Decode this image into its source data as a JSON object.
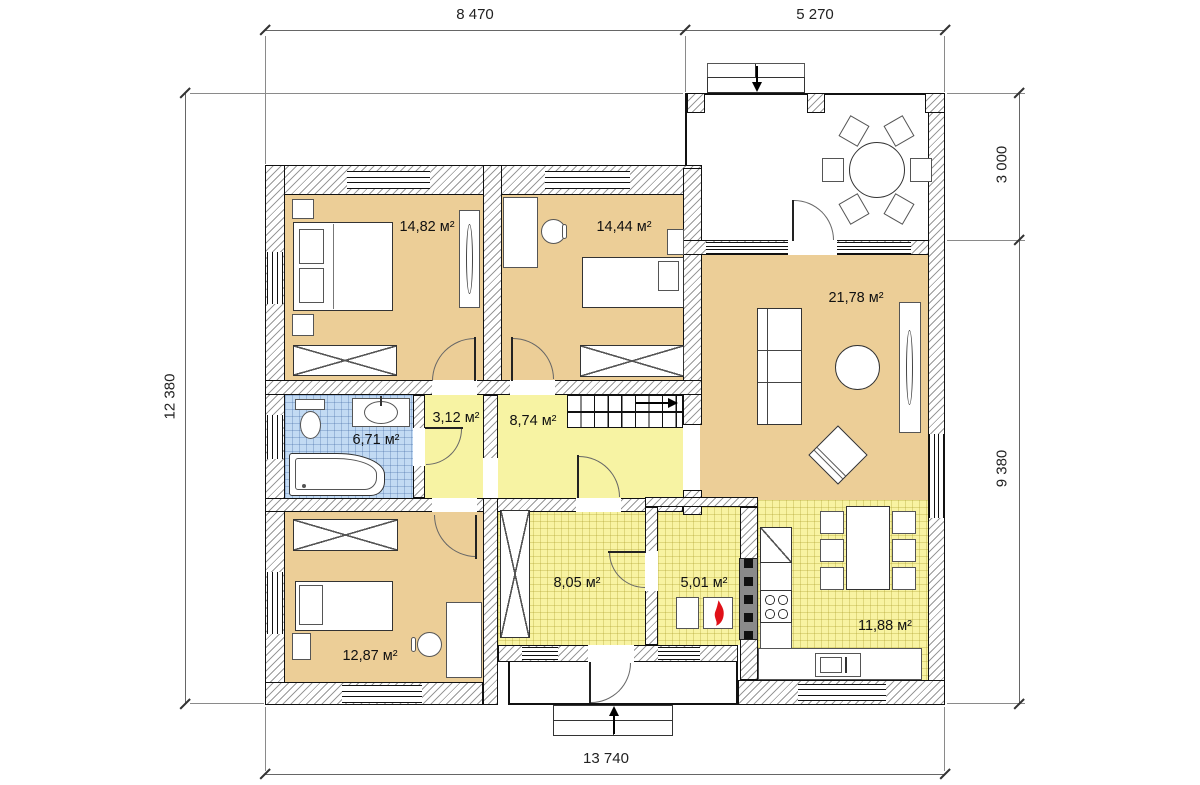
{
  "plan": {
    "dimensions": {
      "top_main": "8 470",
      "top_terrace": "5 270",
      "left_total": "12 380",
      "right_terrace": "3 000",
      "right_main": "9 380",
      "bottom_total": "13 740"
    },
    "rooms": {
      "bedroom1": {
        "area": "14,82 м²"
      },
      "bedroom2": {
        "area": "14,44 м²"
      },
      "living": {
        "area": "21,78 м²"
      },
      "bathroom": {
        "area": "6,71 м²"
      },
      "corridor": {
        "area": "3,12 м²"
      },
      "hall": {
        "area": "8,74 м²"
      },
      "entry": {
        "area": "8,05 м²"
      },
      "boiler": {
        "area": "5,01 м²"
      },
      "bedroom3": {
        "area": "12,87 м²"
      },
      "kitchen": {
        "area": "11,88 м²"
      }
    },
    "colors": {
      "room_tan": "#ecce97",
      "room_yellow": "#f7f3a3",
      "room_blue": "#c2daf3",
      "wall_outline": "#111111",
      "flame_red": "#e01018"
    },
    "icons": {
      "boiler": "flame-icon",
      "stairs": "arrow-right-icon",
      "entries": "arrow-icon"
    }
  }
}
